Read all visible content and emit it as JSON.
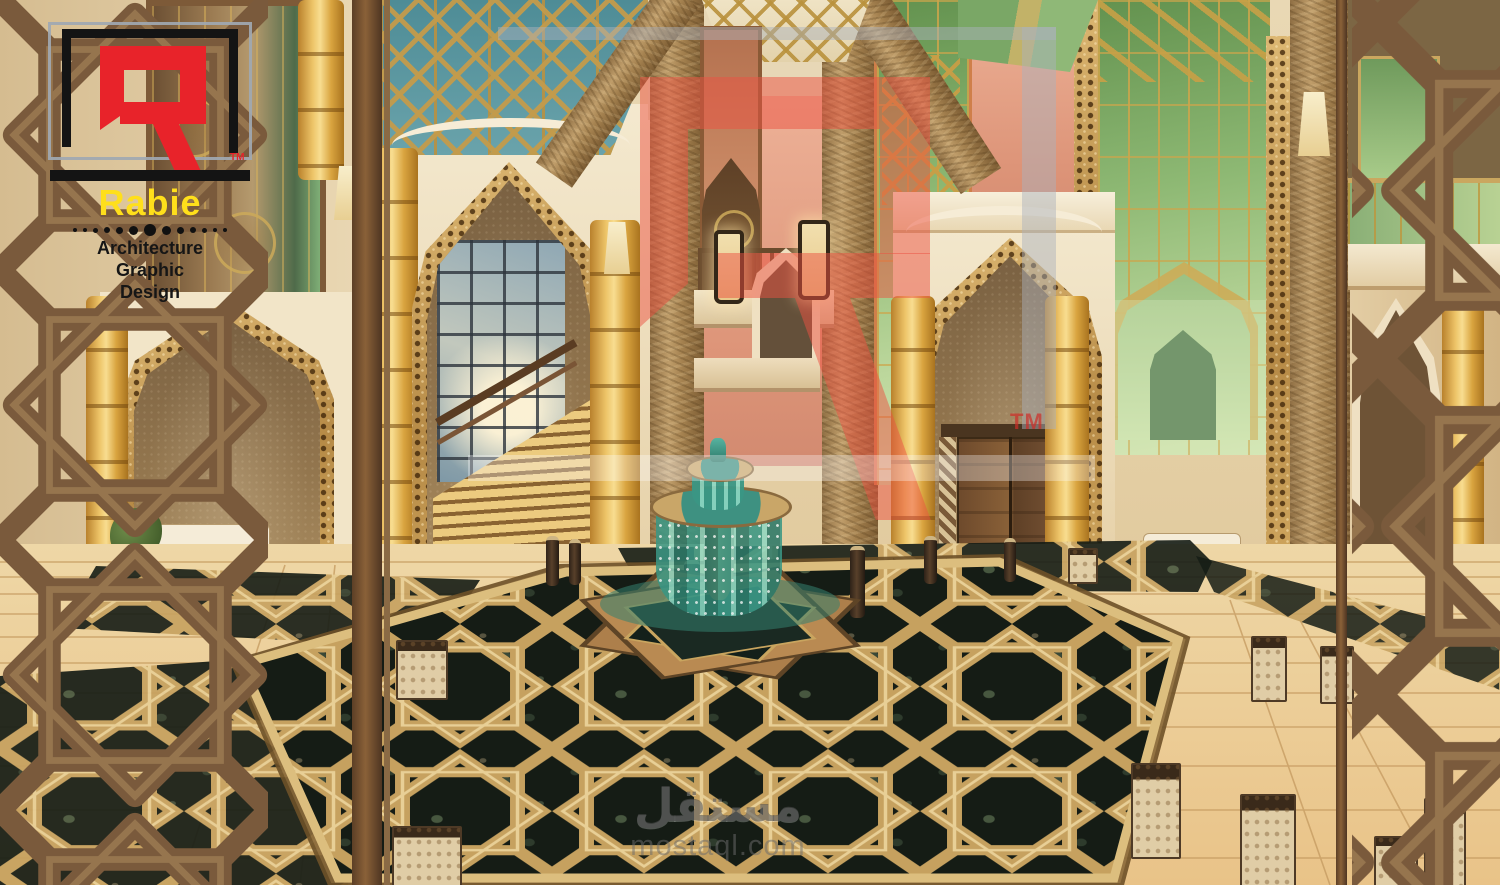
{
  "meta": {
    "type": "3d-architectural-interior-rendering",
    "subject": "Arabic Islamic style hotel lobby atrium with central fountain, dark marble floor with gold geometric strapwork, mashrabiya lattice screens, pointed arches, grand staircase and green glass walls"
  },
  "branding": {
    "logo": {
      "monogram": "R",
      "trademark": "TM",
      "name": "Rabie",
      "services": [
        "Architecture",
        "Graphic",
        "Design"
      ],
      "dot_sizes": [
        4,
        4,
        5,
        6,
        7,
        9,
        12,
        9,
        7,
        6,
        5,
        4,
        4
      ],
      "colors": {
        "monogram_red": "#e8232a",
        "name_yellow": "#ffdf1b",
        "frame_black": "#141414",
        "frame_gray": "#a7adb4"
      }
    },
    "center_watermark": {
      "monogram": "R",
      "trademark": "TM",
      "opacity": 0.5
    },
    "marketplace_watermark": {
      "arabic": "مستقل",
      "latin": "mostaql.com"
    }
  },
  "scene": {
    "palette": {
      "wall_beige": "#e6d2ab",
      "arch_cream": "#f0e3c6",
      "column_gold": "#e7b54a",
      "stone_tan": "#a9854f",
      "accent_salmon": "#e5a183",
      "glass_green": "#8fb877",
      "skylight_teal": "#5a96a0",
      "marble_dark": "#18201a",
      "strap_gold": "#c9a55f",
      "floor_tile": "#ecd2a0",
      "lattice_brown": "#7a5a3c",
      "fountain_teal": "#3f9f8d"
    }
  }
}
